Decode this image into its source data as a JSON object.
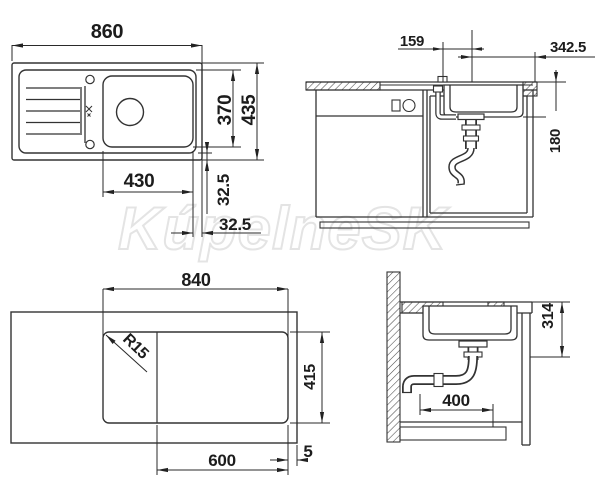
{
  "ink_color": "#2b2b2b",
  "watermark": {
    "text": "KúpelneSK",
    "color": "#e4e4e4"
  },
  "views": {
    "plan_top": {
      "dims": {
        "overall_length": "860",
        "rim_depth": "370",
        "overall_depth": "435",
        "bowl_width": "430",
        "rim_offset_vertical": "32.5",
        "rim_offset_horizontal": "32.5"
      }
    },
    "section_front": {
      "dims": {
        "drain_offset_left": "159",
        "drain_offset_right": "342.5",
        "bowl_depth": "180"
      }
    },
    "cutout_plan": {
      "dims": {
        "cutout_length": "840",
        "corner_radius": "R15",
        "cutout_depth": "415",
        "bowl_section_length": "600",
        "edge_gap": "5"
      }
    },
    "section_side": {
      "dims": {
        "installation_depth": "314",
        "drain_clearance": "400"
      }
    }
  }
}
